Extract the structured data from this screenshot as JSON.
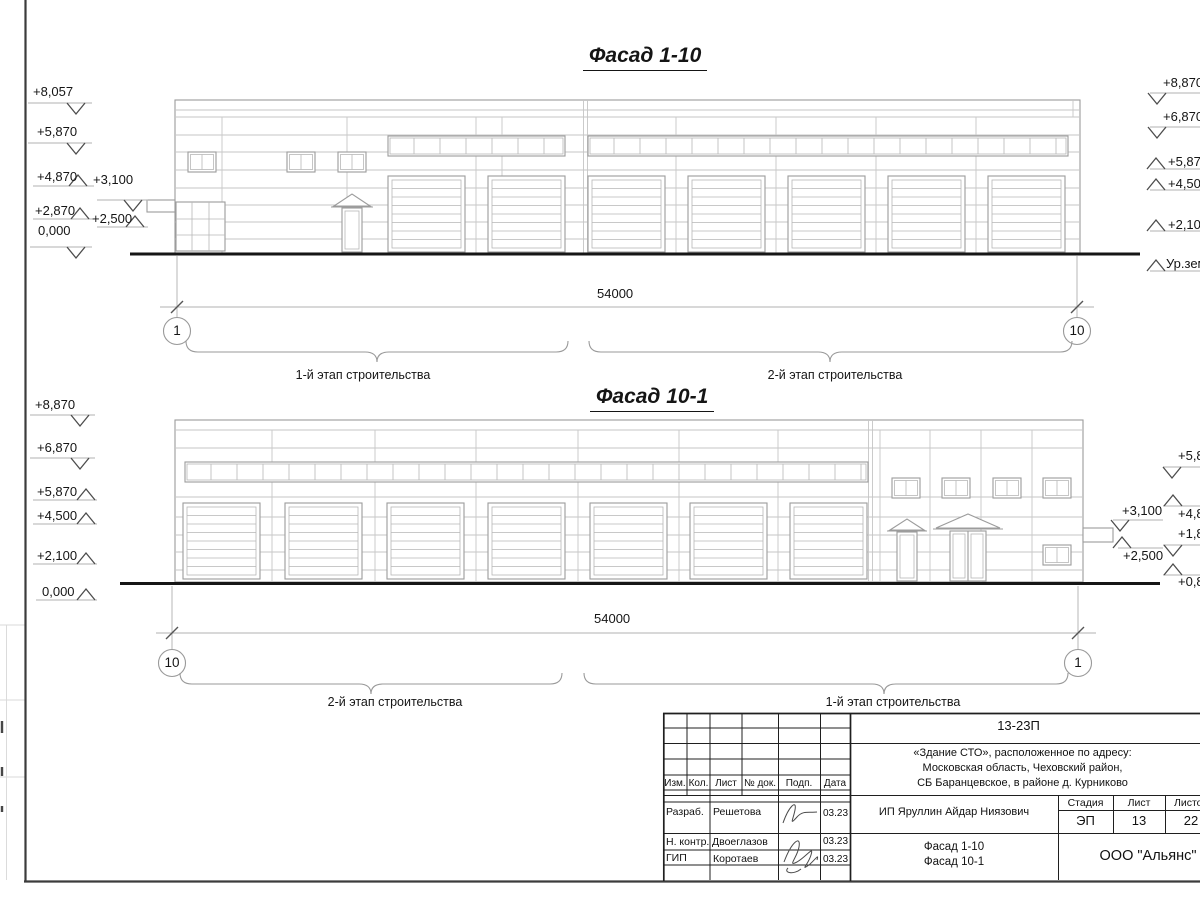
{
  "drawing": {
    "facade_top": {
      "title": "Фасад 1-10",
      "dim": "54000",
      "axis_left": "1",
      "axis_right": "10",
      "stage_left": "1-й этап строительства",
      "stage_right": "2-й этап строительства",
      "marks_left": [
        "+8,057",
        "+5,870",
        "+4,870",
        "+3,100",
        "+2,870",
        "+2,500",
        "0,000"
      ],
      "marks_right": [
        "+8,870",
        "+6,870",
        "+5,870",
        "+4,500",
        "+2,100",
        "Ур.земли"
      ]
    },
    "facade_bottom": {
      "title": "Фасад 10-1",
      "dim": "54000",
      "axis_left": "10",
      "axis_right": "1",
      "stage_left": "2-й этап строительства",
      "stage_right": "1-й этап строительства",
      "marks_left": [
        "+8,870",
        "+6,870",
        "+5,870",
        "+4,500",
        "+2,100",
        "0,000"
      ],
      "marks_inner_right": [
        "+3,100",
        "+2,500"
      ],
      "marks_right": [
        "+5,870",
        "+4,870",
        "+1,870",
        "+0,870"
      ]
    }
  },
  "titleblock": {
    "doc_number": "13-23П",
    "project_lines": [
      "«Здание СТО», расположенное по адресу:",
      "Московская область, Чеховский район,",
      "СБ Баранцевское, в районе д. Курниково"
    ],
    "columns": [
      "Изм.",
      "Кол.",
      "Лист",
      "№ док.",
      "Подп.",
      "Дата"
    ],
    "rows": [
      {
        "role": "Разраб.",
        "name": "Решетова",
        "date": "03.23"
      },
      {
        "role": "Н. контр.",
        "name": "Двоеглазов",
        "date": "03.23"
      },
      {
        "role": "ГИП",
        "name": "Коротаев",
        "date": "03.23"
      }
    ],
    "client": "ИП Яруллин Айдар Ниязович",
    "stage_label": "Стадия",
    "sheet_label": "Лист",
    "sheets_label": "Листов",
    "stage": "ЭП",
    "sheet_no": "13",
    "sheets_total": "22",
    "drawing_name_lines": [
      "Фасад 1-10",
      "Фасад 10-1"
    ],
    "company": "ООО \"Альянс\""
  }
}
